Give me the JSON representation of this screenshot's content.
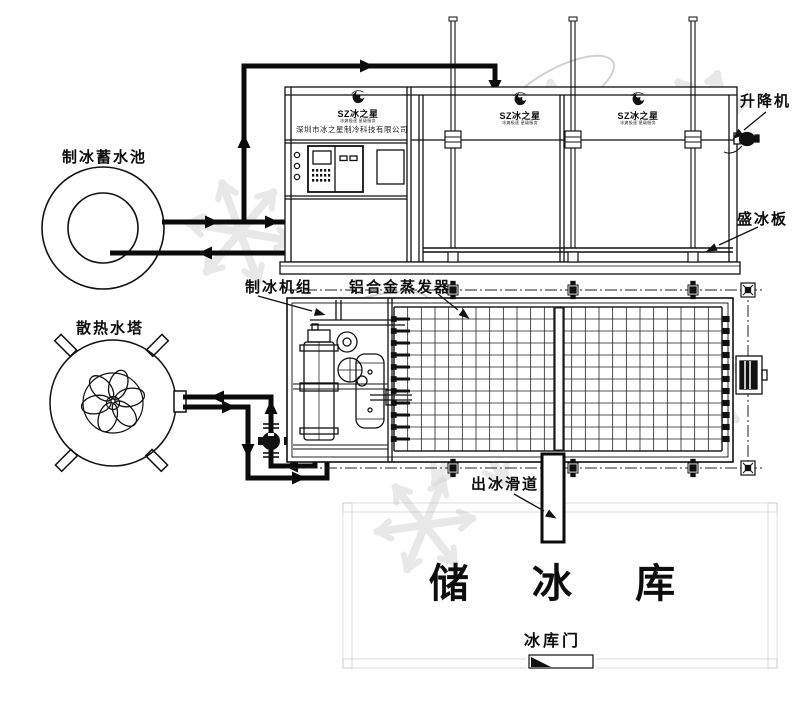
{
  "labels": {
    "water_pool": "制冰蓄水池",
    "cooling_tower": "散热水塔",
    "ice_machine_unit": "制冰机组",
    "evaporator": "铝合金蒸发器",
    "elevator": "升降机",
    "ice_plate": "盛冰板",
    "ice_chute": "出冰滑道",
    "ice_storage": "储 冰 库",
    "storage_door": "冰库门"
  },
  "brand": {
    "logo_text": "SZ冰之星",
    "logo_tagline": "冰爽极速 星级服务",
    "company_name": "深圳市冰之星制冷科技有限公司"
  },
  "colors": {
    "line": "#111111",
    "pipe": "#0b0b0b",
    "wall_hatch": "#9d9d9d",
    "watermark": "#d6d6d6"
  }
}
